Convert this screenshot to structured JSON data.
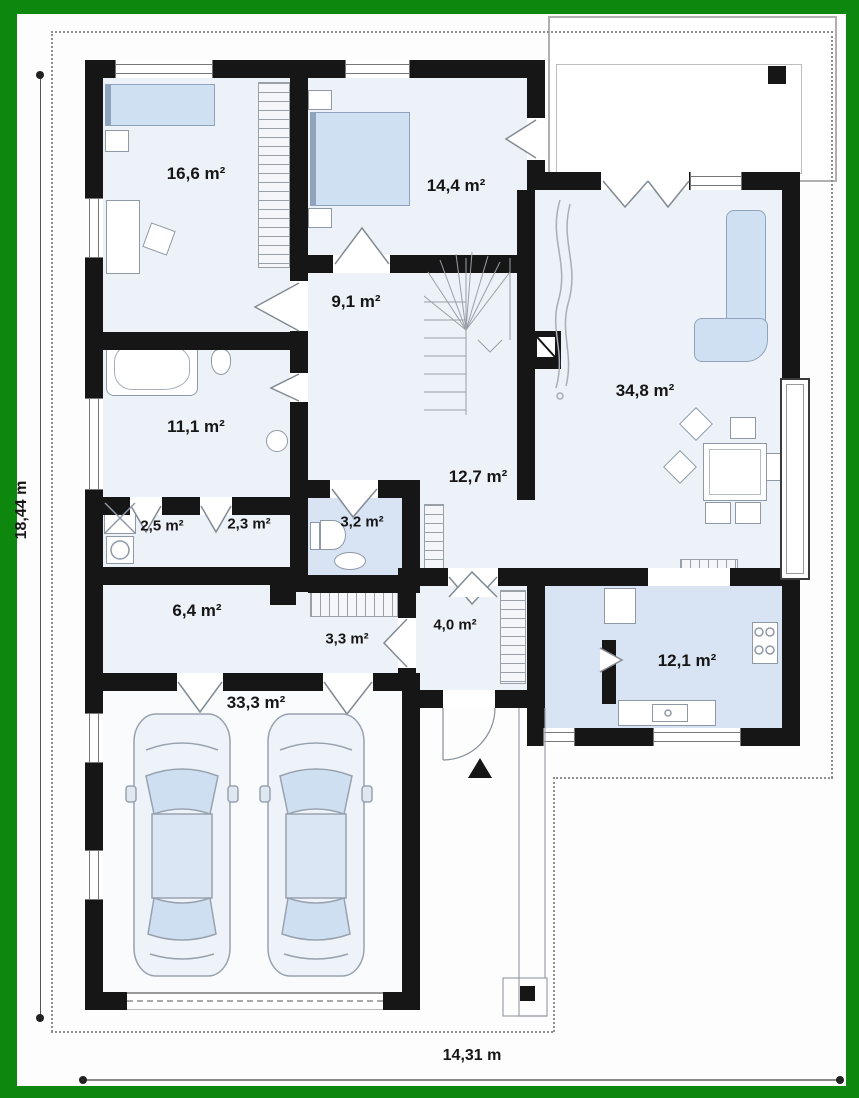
{
  "colors": {
    "frame": "#0e870e",
    "wall": "#161616",
    "floor": "#edf1f8",
    "floor_blue": "#d8e3f3",
    "furniture_blue": "#cfe0f2",
    "line": "#8a8a8a"
  },
  "rooms": [
    {
      "name": "bedroom-1",
      "area": "16,6 m²"
    },
    {
      "name": "bedroom-2",
      "area": "14,4 m²"
    },
    {
      "name": "hall",
      "area": "9,1 m²"
    },
    {
      "name": "bathroom",
      "area": "11,1 m²"
    },
    {
      "name": "laundry",
      "area": "2,5 m²"
    },
    {
      "name": "closet",
      "area": "2,3 m²"
    },
    {
      "name": "wc",
      "area": "3,2 m²"
    },
    {
      "name": "corridor",
      "area": "12,7 m²"
    },
    {
      "name": "living-room",
      "area": "34,8 m²"
    },
    {
      "name": "utility-room",
      "area": "6,4 m²"
    },
    {
      "name": "hallway",
      "area": "3,3 m²"
    },
    {
      "name": "vestibule",
      "area": "4,0 m²"
    },
    {
      "name": "garage",
      "area": "33,3 m²"
    },
    {
      "name": "kitchen",
      "area": "12,1 m²"
    }
  ],
  "dimensions": {
    "height_label": "18,44 m",
    "width_label": "14,31 m"
  }
}
